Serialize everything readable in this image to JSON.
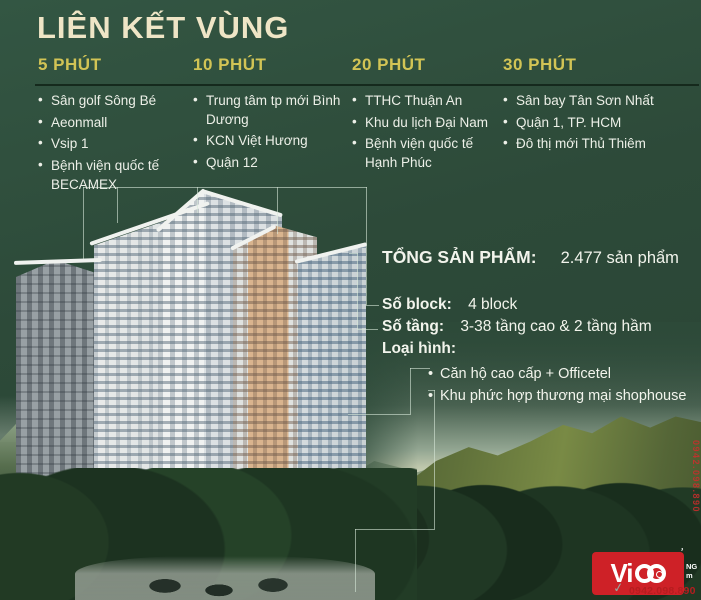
{
  "title": "LIÊN KẾT VÙNG",
  "columns": [
    {
      "header": "5 PHÚT",
      "items": [
        "Sân golf Sông Bé",
        "Aeonmall",
        "Vsip 1",
        "Bệnh viện quốc tế BECAMEX"
      ]
    },
    {
      "header": "10 PHÚT",
      "items": [
        "Trung tâm tp mới Bình Dương",
        "KCN Việt Hương",
        "Quận 12"
      ]
    },
    {
      "header": "20 PHÚT",
      "items": [
        "TTHC Thuận An",
        "Khu du lịch Đại Nam",
        "Bệnh viện quốc tế Hạnh Phúc"
      ]
    },
    {
      "header": "30 PHÚT",
      "items": [
        "Sân bay Tân Sơn Nhất",
        "Quận 1, TP. HCM",
        "Đô thị mới Thủ Thiêm"
      ]
    }
  ],
  "info": {
    "total_label": "TỔNG SẢN PHẨM:",
    "total_value": "2.477 sản phẩm",
    "block_label": "Số block:",
    "block_value": "4 block",
    "floors_label": "Số tầng:",
    "floors_value": "3-38 tầng cao & 2 tầng hầm",
    "type_label": "Loại hình:",
    "types": [
      "Căn hộ cao cấp + Officetel",
      "Khu phức hợp thương mại shophouse"
    ]
  },
  "watermark": {
    "brand": "ViCO",
    "brand_text_part": "Vi",
    "clipped_text_top": "NG",
    "clipped_text_bottom": "m",
    "phone": "0942.098.890",
    "edge_phone": "0942.098.890"
  },
  "colors": {
    "background_green": "#2d4a39",
    "title_cream": "#efe5c6",
    "heading_gold": "#d2c455",
    "body_text": "#eef0e8",
    "rule_dark": "#132619",
    "connector_line": "#d7e8d8",
    "logo_red": "#ce2127",
    "phone_red": "#b61d1f"
  }
}
